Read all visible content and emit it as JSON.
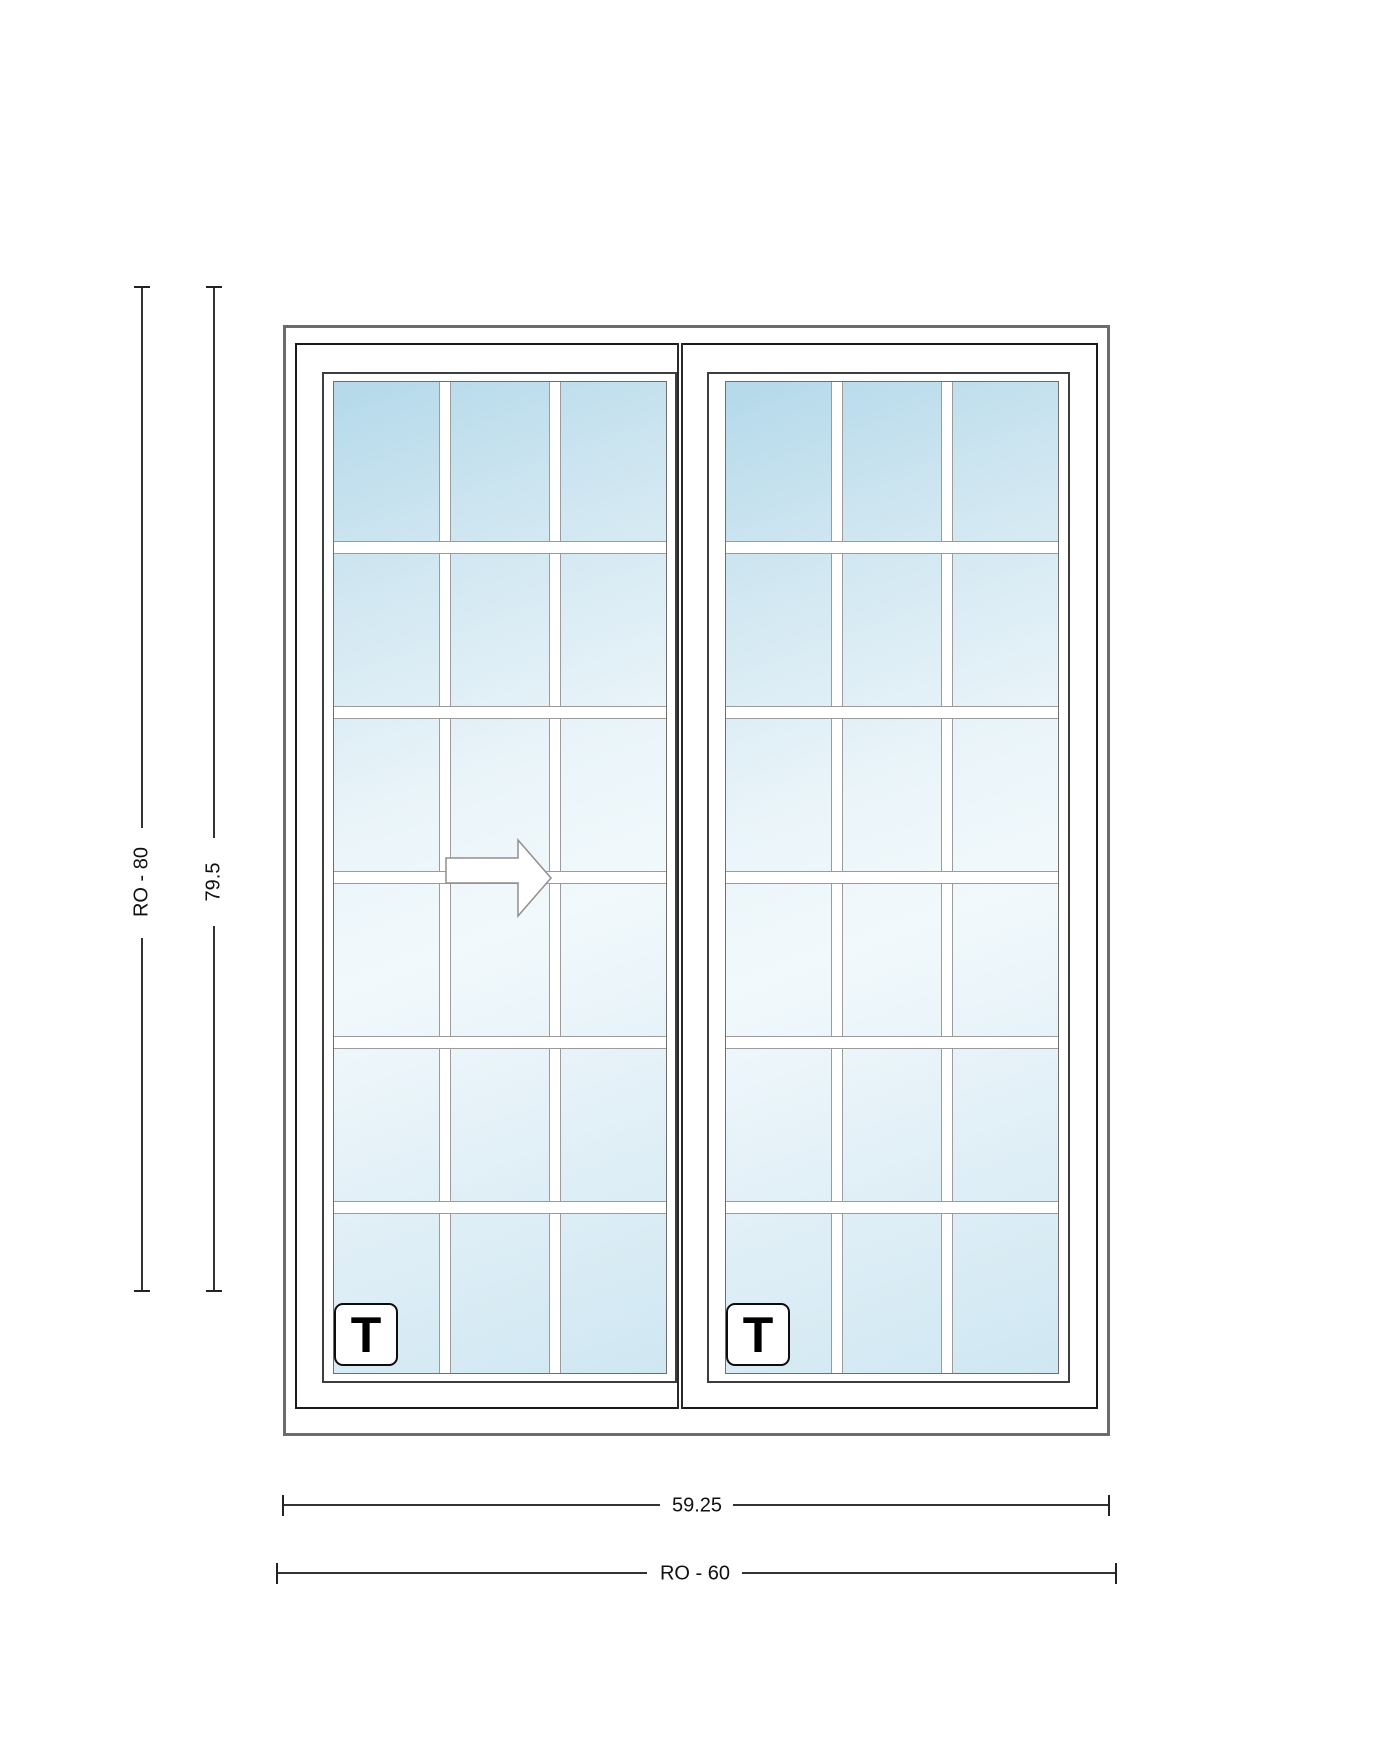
{
  "drawing": {
    "type": "window-elevation",
    "dimensions": {
      "height_ro": "RO - 80",
      "height_unit": "79.5",
      "width_unit": "59.25",
      "width_ro": "RO - 60"
    },
    "tempered_mark": "T",
    "grid": {
      "columns": 3,
      "rows": 6
    },
    "panels": {
      "count": 2,
      "operable": "left",
      "slide_direction": "right"
    },
    "colors": {
      "outer_frame": "#6b6b6b",
      "inner_frame": "#1a1a1a",
      "sash_border": "#3d3d3d",
      "muntin_border": "#9b9b9b",
      "glass_dark": "#b4d9ea",
      "glass_light": "#f2f9fc",
      "dimension_line": "#333333",
      "dimension_text": "#111111"
    }
  }
}
